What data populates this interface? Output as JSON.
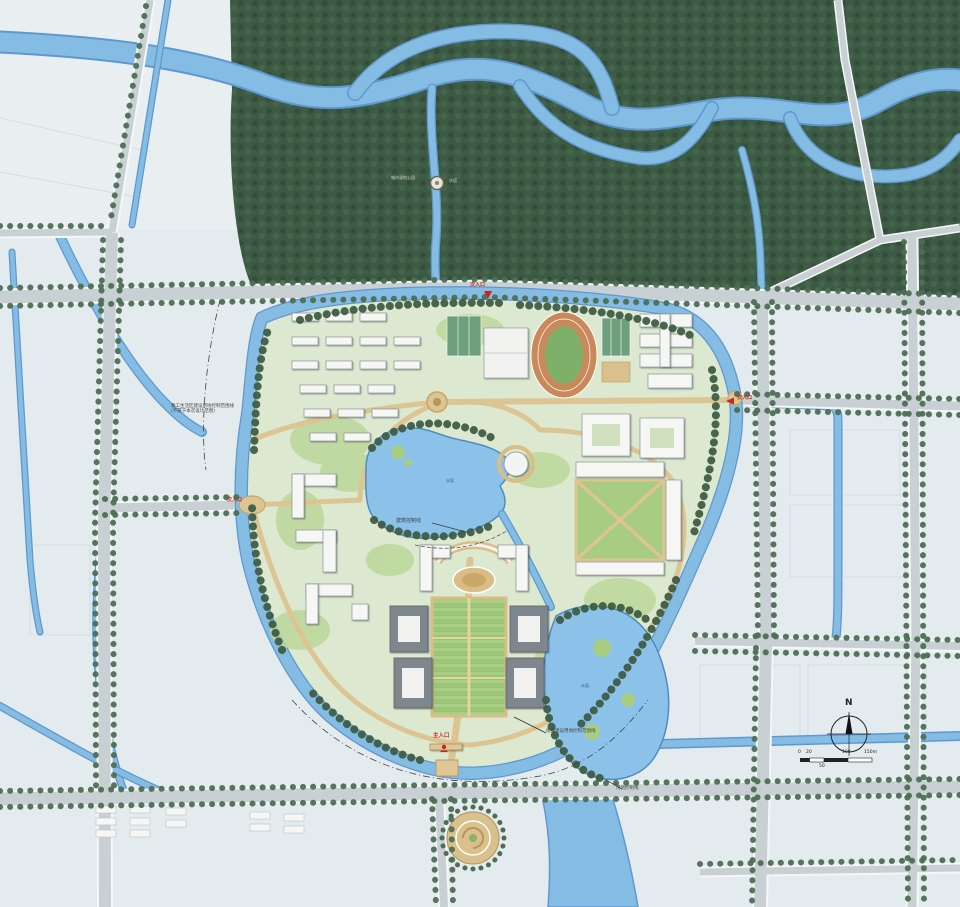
{
  "map": {
    "region_labels": {
      "wetland_park": "城市湿地公园",
      "pagoda": "水塔",
      "staff_zone_line1": "教工生活区建设用地控制范围线",
      "staff_zone_line2": "(不属于本次设计范围)",
      "building_control_line": "建筑控制线",
      "campus_boundary_line": "校园建设用地控制范围线",
      "land_use_line": "用地控制线",
      "lake": "水面",
      "pond": "水面"
    },
    "entrances": {
      "north_secondary": "次入口",
      "east_secondary": "次入口",
      "west_secondary": "次入口",
      "south_main": "主入口"
    },
    "compass": {
      "north": "N"
    },
    "scale_bar": {
      "ticks": [
        "0",
        "20",
        "100",
        "150m"
      ],
      "mid_tick": "50"
    },
    "colors": {
      "water": "#85bce4",
      "forest_green": "#3d5a44",
      "campus_green": "#dce8d0",
      "road_gray": "#c9d0d4",
      "plaza_tan": "#d9bd85",
      "building_white": "#f6f7f5",
      "entrance_red": "#c4281e"
    }
  }
}
